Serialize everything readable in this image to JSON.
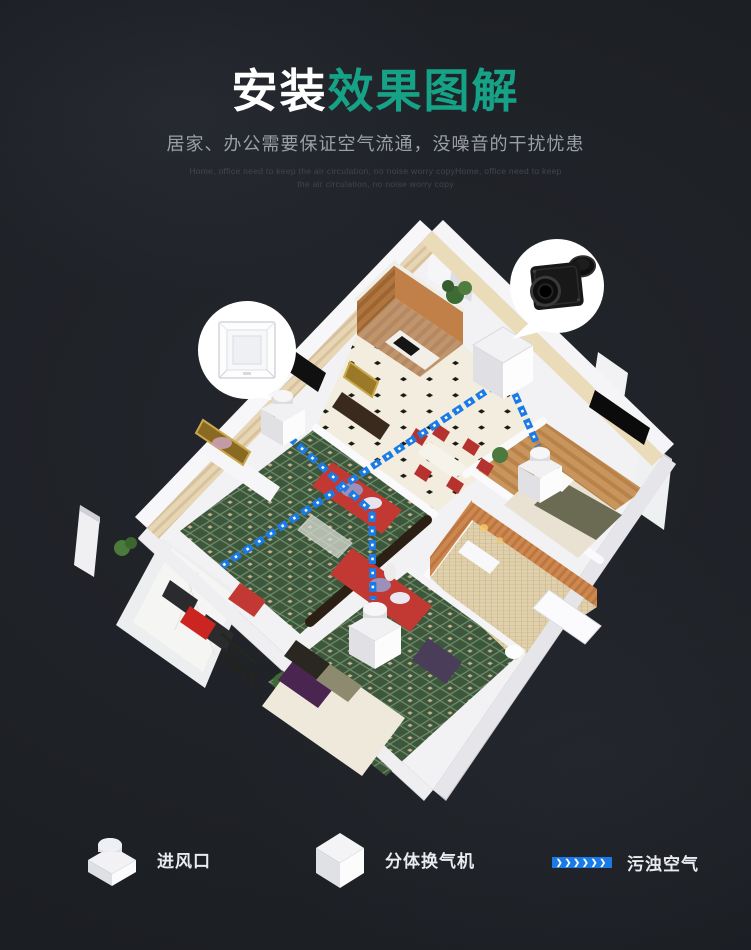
{
  "theme": {
    "background": "#1f2227",
    "accent_green": "#16a287",
    "title_white": "#ffffff",
    "subtitle_gray": "#99a0a7",
    "subtitle_en_gray": "#41464d",
    "arrow_blue": "#1b7be6",
    "legend_text": "#e9ebee"
  },
  "header": {
    "title_part1": "安装",
    "title_part2": "效果图解",
    "subtitle": "居家、办公需要保证空气流通，没噪音的干扰忧患",
    "subtitle_en_line1": "Home, office need to keep the air circulation, no noise worry copyHome, office need to keep",
    "subtitle_en_line2": "the air circulation, no noise worry copy"
  },
  "legend": {
    "items": [
      {
        "id": "air-inlet",
        "label": "进风口"
      },
      {
        "id": "split-ventilator",
        "label": "分体换气机"
      },
      {
        "id": "polluted-air",
        "label": "污浊空气",
        "arrow_glyphs": "❯❯❯❯❯❯"
      }
    ]
  }
}
